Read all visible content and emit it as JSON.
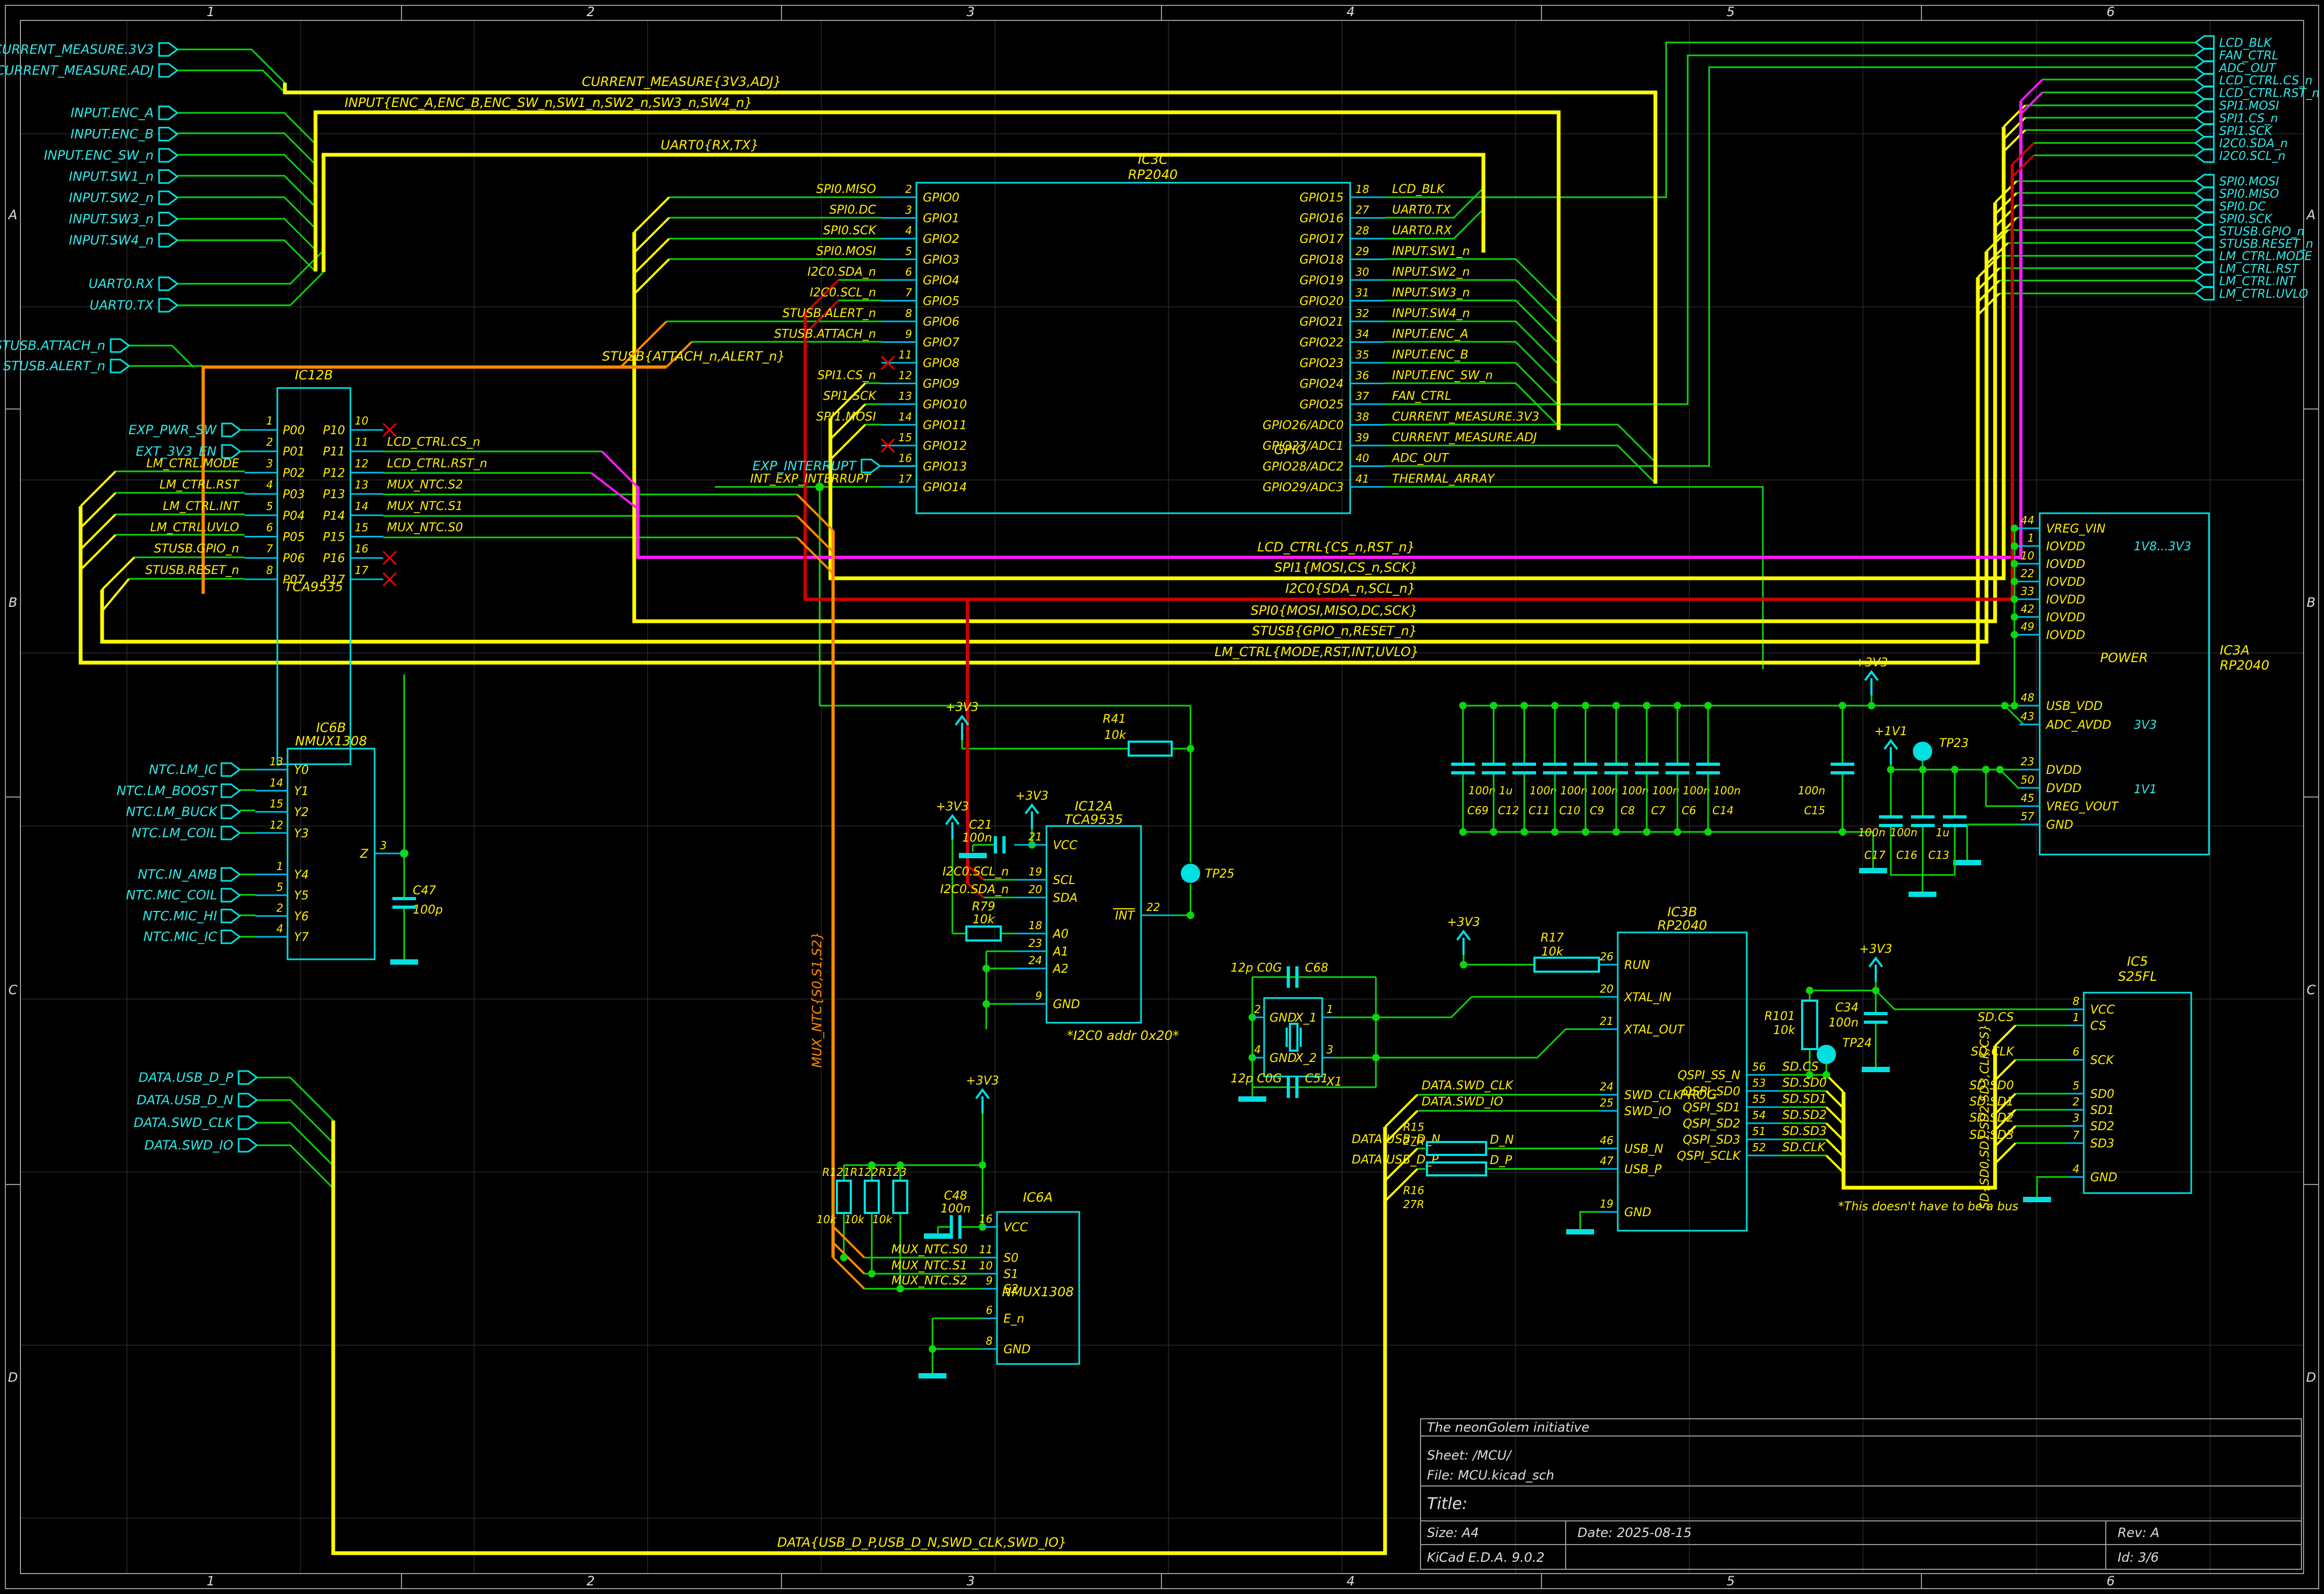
{
  "sheet": {
    "cols": [
      "1",
      "2",
      "3",
      "4",
      "5",
      "6"
    ],
    "rows": [
      "A",
      "B",
      "C",
      "D"
    ],
    "colors": {
      "wire": "#0cd60c",
      "bus": "#ffff00",
      "symbol": "#00e0e0",
      "label": "#ffef00",
      "magenta": "#ff1aff",
      "red": "#cf0000",
      "orange": "#ff8a00"
    }
  },
  "title_block": {
    "company": "The neonGolem initiative",
    "sheet_label": "Sheet: /MCU/",
    "file_label": "File: MCU.kicad_sch",
    "title_label": "Title:",
    "size_label": "Size: A4",
    "date_label": "Date: 2025-08-15",
    "rev_label": "Rev: A",
    "tool_label": "KiCad E.D.A. 9.0.2",
    "id_label": "Id: 3/6"
  },
  "hier_left": {
    "current": [
      "CURRENT_MEASURE.3V3",
      "CURRENT_MEASURE.ADJ"
    ],
    "input": [
      "INPUT.ENC_A",
      "INPUT.ENC_B",
      "INPUT.ENC_SW_n",
      "INPUT.SW1_n",
      "INPUT.SW2_n",
      "INPUT.SW3_n",
      "INPUT.SW4_n"
    ],
    "uart": [
      "UART0.RX",
      "UART0.TX"
    ],
    "stusb": [
      "STUSB.ATTACH_n",
      "STUSB.ALERT_n"
    ],
    "data": [
      "DATA.USB_D_P",
      "DATA.USB_D_N",
      "DATA.SWD_CLK",
      "DATA.SWD_IO"
    ],
    "exp_pwr": "EXP_PWR_SW",
    "ext_3v3": "EXT_3V3_EN",
    "exp_interrupt": "EXP_INTERRUPT"
  },
  "hier_right": {
    "top": [
      "LCD_BLK",
      "FAN_CTRL",
      "ADC_OUT",
      "LCD_CTRL.CS_n",
      "LCD_CTRL.RST_n",
      "SPI1.MOSI",
      "SPI1.CS_n",
      "SPI1.SCK",
      "I2C0.SDA_n",
      "I2C0.SCL_n"
    ],
    "bottom": [
      "SPI0.MOSI",
      "SPI0.MISO",
      "SPI0.DC",
      "SPI0.SCK",
      "STUSB.GPIO_n",
      "STUSB.RESET_n",
      "LM_CTRL.MODE",
      "LM_CTRL.RST",
      "LM_CTRL.INT",
      "LM_CTRL.UVLO"
    ]
  },
  "bus_labels": {
    "current": "CURRENT_MEASURE{3V3,ADJ}",
    "input": "INPUT{ENC_A,ENC_B,ENC_SW_n,SW1_n,SW2_n,SW3_n,SW4_n}",
    "uart": "UART0{RX,TX}",
    "stusb_attach": "STUSB{ATTACH_n,ALERT_n}",
    "lcd": "LCD_CTRL{CS_n,RST_n}",
    "spi1": "SPI1{MOSI,CS_n,SCK}",
    "i2c0": "I2C0{SDA_n,SCL_n}",
    "spi0": "SPI0{MOSI,MISO,DC,SCK}",
    "stusb": "STUSB{GPIO_n,RESET_n}",
    "lm": "LM_CTRL{MODE,RST,INT,UVLO}",
    "mux": "MUX_NTC{S0,S1,S2}",
    "sd": "SD{SD0,SD1,SD2,SD3,CLK,CS}",
    "data": "DATA{USB_D_P,USB_D_N,SWD_CLK,SWD_IO}"
  },
  "ic3c": {
    "ref": "IC3C",
    "part": "RP2040",
    "function": "GPIO",
    "left_pins": [
      {
        "num": "2",
        "name": "GPIO0",
        "label": "SPI0.MISO"
      },
      {
        "num": "3",
        "name": "GPIO1",
        "label": "SPI0.DC"
      },
      {
        "num": "4",
        "name": "GPIO2",
        "label": "SPI0.SCK"
      },
      {
        "num": "5",
        "name": "GPIO3",
        "label": "SPI0.MOSI"
      },
      {
        "num": "6",
        "name": "GPIO4",
        "label": "I2C0.SDA_n"
      },
      {
        "num": "7",
        "name": "GPIO5",
        "label": "I2C0.SCL_n"
      },
      {
        "num": "8",
        "name": "GPIO6",
        "label": "STUSB.ALERT_n"
      },
      {
        "num": "9",
        "name": "GPIO7",
        "label": "STUSB.ATTACH_n"
      },
      {
        "num": "11",
        "name": "GPIO8",
        "label": ""
      },
      {
        "num": "12",
        "name": "GPIO9",
        "label": "SPI1.CS_n"
      },
      {
        "num": "13",
        "name": "GPIO10",
        "label": "SPI1.SCK"
      },
      {
        "num": "14",
        "name": "GPIO11",
        "label": "SPI1.MOSI"
      },
      {
        "num": "15",
        "name": "GPIO12",
        "label": ""
      },
      {
        "num": "16",
        "name": "GPIO13",
        "label": ""
      },
      {
        "num": "17",
        "name": "GPIO14",
        "label": ""
      }
    ],
    "right_pins": [
      {
        "num": "18",
        "name": "GPIO15",
        "label": "LCD_BLK"
      },
      {
        "num": "27",
        "name": "GPIO16",
        "label": "UART0.TX"
      },
      {
        "num": "28",
        "name": "GPIO17",
        "label": "UART0.RX"
      },
      {
        "num": "29",
        "name": "GPIO18",
        "label": "INPUT.SW1_n"
      },
      {
        "num": "30",
        "name": "GPIO19",
        "label": "INPUT.SW2_n"
      },
      {
        "num": "31",
        "name": "GPIO20",
        "label": "INPUT.SW3_n"
      },
      {
        "num": "32",
        "name": "GPIO21",
        "label": "INPUT.SW4_n"
      },
      {
        "num": "34",
        "name": "GPIO22",
        "label": "INPUT.ENC_A"
      },
      {
        "num": "35",
        "name": "GPIO23",
        "label": "INPUT.ENC_B"
      },
      {
        "num": "36",
        "name": "GPIO24",
        "label": "INPUT.ENC_SW_n"
      },
      {
        "num": "37",
        "name": "GPIO25",
        "label": "FAN_CTRL"
      },
      {
        "num": "38",
        "name": "GPIO26/ADC0",
        "label": "CURRENT_MEASURE.3V3"
      },
      {
        "num": "39",
        "name": "GPIO27/ADC1",
        "label": "CURRENT_MEASURE.ADJ"
      },
      {
        "num": "40",
        "name": "GPIO28/ADC2",
        "label": "ADC_OUT"
      },
      {
        "num": "41",
        "name": "GPIO29/ADC3",
        "label": "THERMAL_ARRAY"
      }
    ],
    "int_exp_label": "INT_EXP_INTERRUPT"
  },
  "ic12b": {
    "ref": "IC12B",
    "part": "TCA9535",
    "left_pins": [
      {
        "num": "1",
        "name": "P00",
        "label": ""
      },
      {
        "num": "2",
        "name": "P01",
        "label": ""
      },
      {
        "num": "3",
        "name": "P02",
        "label": "LM_CTRL.MODE"
      },
      {
        "num": "4",
        "name": "P03",
        "label": "LM_CTRL.RST"
      },
      {
        "num": "5",
        "name": "P04",
        "label": "LM_CTRL.INT"
      },
      {
        "num": "6",
        "name": "P05",
        "label": "LM_CTRL.UVLO"
      },
      {
        "num": "7",
        "name": "P06",
        "label": "STUSB.GPIO_n"
      },
      {
        "num": "8",
        "name": "P07",
        "label": "STUSB.RESET_n"
      }
    ],
    "right_pins": [
      {
        "num": "10",
        "name": "P10",
        "label": ""
      },
      {
        "num": "11",
        "name": "P11",
        "label": "LCD_CTRL.CS_n"
      },
      {
        "num": "12",
        "name": "P12",
        "label": "LCD_CTRL.RST_n"
      },
      {
        "num": "13",
        "name": "P13",
        "label": "MUX_NTC.S2"
      },
      {
        "num": "14",
        "name": "P14",
        "label": "MUX_NTC.S1"
      },
      {
        "num": "15",
        "name": "P15",
        "label": "MUX_NTC.S0"
      },
      {
        "num": "16",
        "name": "P16",
        "label": ""
      },
      {
        "num": "17",
        "name": "P17",
        "label": ""
      }
    ]
  },
  "ic12a": {
    "ref": "IC12A",
    "part": "TCA9535",
    "note": "*I2C0 addr 0x20*",
    "pins": [
      {
        "num": "21",
        "name": "VCC",
        "label": ""
      },
      {
        "num": "19",
        "name": "SCL",
        "label": "I2C0.SCL_n"
      },
      {
        "num": "20",
        "name": "SDA",
        "label": "I2C0.SDA_n"
      },
      {
        "num": "18",
        "name": "A0",
        "label": ""
      },
      {
        "num": "23",
        "name": "A1",
        "label": ""
      },
      {
        "num": "24",
        "name": "A2",
        "label": ""
      },
      {
        "num": "9",
        "name": "GND",
        "label": ""
      }
    ],
    "int_pin": {
      "num": "22",
      "name": "INT"
    }
  },
  "ic6b": {
    "ref": "IC6B",
    "part": "NMUX1308",
    "left_pins_a": [
      {
        "num": "13",
        "name": "Y0",
        "label": "NTC.LM_IC"
      },
      {
        "num": "14",
        "name": "Y1",
        "label": "NTC.LM_BOOST"
      },
      {
        "num": "15",
        "name": "Y2",
        "label": "NTC.LM_BUCK"
      },
      {
        "num": "12",
        "name": "Y3",
        "label": "NTC.LM_COIL"
      }
    ],
    "left_pins_b": [
      {
        "num": "1",
        "name": "Y4",
        "label": "NTC.IN_AMB"
      },
      {
        "num": "5",
        "name": "Y5",
        "label": "NTC.MIC_COIL"
      },
      {
        "num": "2",
        "name": "Y6",
        "label": "NTC.MIC_HI"
      },
      {
        "num": "4",
        "name": "Y7",
        "label": "NTC.MIC_IC"
      }
    ],
    "z_pin": {
      "num": "3",
      "name": "Z"
    }
  },
  "ic6a": {
    "ref": "IC6A",
    "part": "NMUX1308",
    "pins": [
      {
        "num": "16",
        "name": "VCC",
        "label": ""
      },
      {
        "num": "11",
        "name": "S0",
        "label": "MUX_NTC.S0"
      },
      {
        "num": "10",
        "name": "S1",
        "label": "MUX_NTC.S1"
      },
      {
        "num": "9",
        "name": "S2",
        "label": "MUX_NTC.S2"
      },
      {
        "num": "6",
        "name": "E_n",
        "label": ""
      },
      {
        "num": "8",
        "name": "GND",
        "label": ""
      }
    ]
  },
  "ic3b": {
    "ref": "IC3B",
    "part": "RP2040",
    "function": "PROG",
    "left_pins": [
      {
        "num": "26",
        "name": "RUN"
      },
      {
        "num": "20",
        "name": "XTAL_IN"
      },
      {
        "num": "21",
        "name": "XTAL_OUT"
      },
      {
        "num": "24",
        "name": "SWD_CLK"
      },
      {
        "num": "25",
        "name": "SWD_IO"
      },
      {
        "num": "46",
        "name": "USB_N"
      },
      {
        "num": "47",
        "name": "USB_P"
      },
      {
        "num": "19",
        "name": "GND"
      }
    ],
    "right_pins": [
      {
        "num": "56",
        "name": "QSPI_SS_N"
      },
      {
        "num": "53",
        "name": "QSPI_SD0"
      },
      {
        "num": "55",
        "name": "QSPI_SD1"
      },
      {
        "num": "54",
        "name": "QSPI_SD2"
      },
      {
        "num": "51",
        "name": "QSPI_SD3"
      },
      {
        "num": "52",
        "name": "QSPI_SCLK"
      }
    ],
    "sd_labels": [
      "SD.CS",
      "SD.SD0",
      "SD.SD1",
      "SD.SD2",
      "SD.SD3",
      "SD.CLK"
    ],
    "data_labels": [
      "DATA.SWD_CLK",
      "DATA.SWD_IO",
      "DATA.USB_D_N",
      "DATA.USB_D_P"
    ],
    "dn": "D_N",
    "dp": "D_P"
  },
  "ic3a": {
    "ref": "IC3A",
    "part": "RP2040",
    "function": "POWER",
    "pins_top": [
      {
        "num": "44",
        "name": "VREG_VIN"
      },
      {
        "num": "1",
        "name": "IOVDD"
      },
      {
        "num": "10",
        "name": "IOVDD"
      },
      {
        "num": "22",
        "name": "IOVDD"
      },
      {
        "num": "33",
        "name": "IOVDD"
      },
      {
        "num": "42",
        "name": "IOVDD"
      },
      {
        "num": "49",
        "name": "IOVDD"
      }
    ],
    "pins_mid": [
      {
        "num": "48",
        "name": "USB_VDD"
      },
      {
        "num": "43",
        "name": "ADC_AVDD"
      }
    ],
    "pins_bot": [
      {
        "num": "23",
        "name": "DVDD"
      },
      {
        "num": "50",
        "name": "DVDD"
      },
      {
        "num": "45",
        "name": "VREG_VOUT"
      },
      {
        "num": "57",
        "name": "GND"
      }
    ],
    "notes": {
      "iovdd": "1V8...3V3",
      "adc": "3V3",
      "dvdd": "1V1"
    }
  },
  "ic5": {
    "ref": "IC5",
    "part": "S25FL",
    "pins": [
      {
        "num": "8",
        "name": "VCC",
        "label": ""
      },
      {
        "num": "1",
        "name": "CS",
        "label": "SD.CS"
      },
      {
        "num": "6",
        "name": "SCK",
        "label": "SD.CLK"
      },
      {
        "num": "5",
        "name": "SD0",
        "label": "SD.SD0"
      },
      {
        "num": "2",
        "name": "SD1",
        "label": "SD.SD1"
      },
      {
        "num": "3",
        "name": "SD2",
        "label": "SD.SD2"
      },
      {
        "num": "7",
        "name": "SD3",
        "label": "SD.SD3"
      },
      {
        "num": "4",
        "name": "GND",
        "label": ""
      }
    ]
  },
  "x1": {
    "ref": "X1",
    "pins": [
      {
        "num": "2",
        "name": "GND"
      },
      {
        "num": "4",
        "name": "GND"
      },
      {
        "num": "1",
        "name": "X_1"
      },
      {
        "num": "3",
        "name": "X_2"
      }
    ],
    "c_top": {
      "ref": "C68",
      "val": "12p C0G"
    },
    "c_bot": {
      "ref": "C51",
      "val": "12p C0G"
    }
  },
  "passives": {
    "bank": [
      {
        "ref": "C69",
        "val": "100n"
      },
      {
        "ref": "C12",
        "val": "1u"
      },
      {
        "ref": "C11",
        "val": "100n"
      },
      {
        "ref": "C10",
        "val": "100n"
      },
      {
        "ref": "C9",
        "val": "100n"
      },
      {
        "ref": "C8",
        "val": "100n"
      },
      {
        "ref": "C7",
        "val": "100n"
      },
      {
        "ref": "C6",
        "val": "100n"
      },
      {
        "ref": "C14",
        "val": "100n"
      }
    ],
    "c15": {
      "ref": "C15",
      "val": "100n"
    },
    "v11caps": [
      {
        "ref": "C17",
        "val": "100n"
      },
      {
        "ref": "C16",
        "val": "100n"
      },
      {
        "ref": "C13",
        "val": "1u"
      }
    ],
    "c21": {
      "ref": "C21",
      "val": "100n"
    },
    "c34": {
      "ref": "C34",
      "val": "100n"
    },
    "c47": {
      "ref": "C47",
      "val": "100p"
    },
    "c48": {
      "ref": "C48",
      "val": "100n"
    },
    "r17": {
      "ref": "R17",
      "val": "10k"
    },
    "r41": {
      "ref": "R41",
      "val": "10k"
    },
    "r79": {
      "ref": "R79",
      "val": "10k"
    },
    "r101": {
      "ref": "R101",
      "val": "10k"
    },
    "r121": {
      "ref": "R121",
      "val": "10k"
    },
    "r122": {
      "ref": "R122",
      "val": "10k"
    },
    "r123": {
      "ref": "R123",
      "val": "10k"
    },
    "r15": {
      "ref": "R15",
      "val": "27R"
    },
    "r16": {
      "ref": "R16",
      "val": "27R"
    }
  },
  "testpoints": {
    "tp23": "TP23",
    "tp24": "TP24",
    "tp25": "TP25"
  },
  "power": {
    "p3v3": "+3V3",
    "p1v1": "+1V1"
  },
  "notes": {
    "bus_note": "*This doesn't have to be a bus"
  }
}
